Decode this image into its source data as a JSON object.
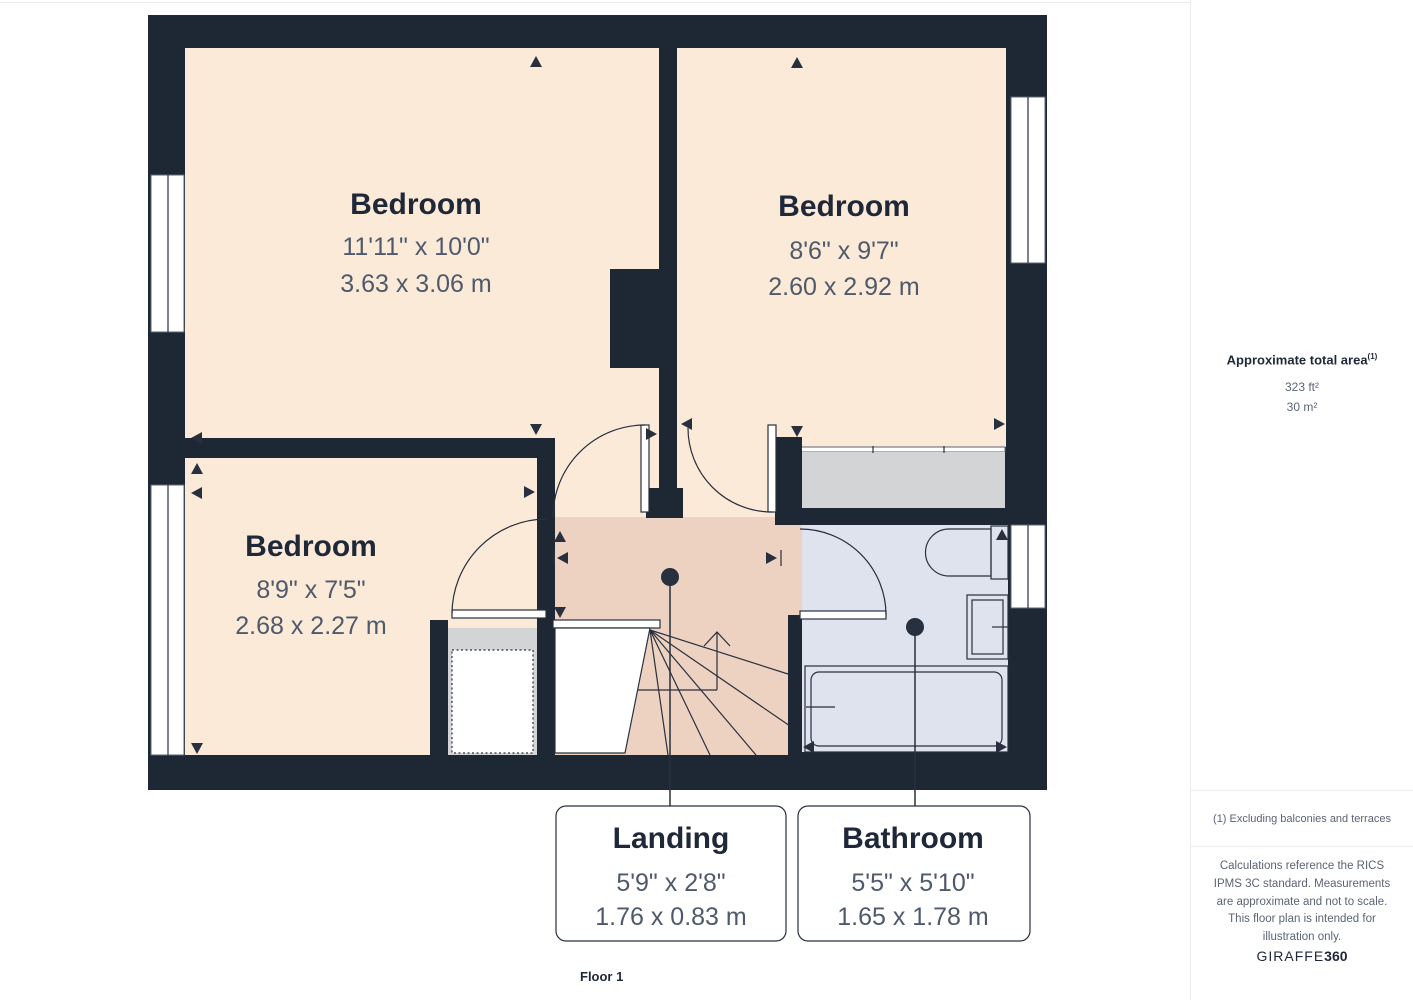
{
  "floorplan": {
    "floor_label": "Floor 1",
    "rooms": [
      {
        "name": "Bedroom",
        "dim_imperial": "11'11\" x 10'0\"",
        "dim_metric": "3.63 x 3.06 m"
      },
      {
        "name": "Bedroom",
        "dim_imperial": "8'6\" x 9'7\"",
        "dim_metric": "2.60 x 2.92 m"
      },
      {
        "name": "Bedroom",
        "dim_imperial": "8'9\" x 7'5\"",
        "dim_metric": "2.68 x 2.27 m"
      },
      {
        "name": "Landing",
        "dim_imperial": "5'9\" x 2'8\"",
        "dim_metric": "1.76 x 0.83 m"
      },
      {
        "name": "Bathroom",
        "dim_imperial": "5'5\" x 5'10\"",
        "dim_metric": "1.65 x 1.78 m"
      }
    ],
    "colors": {
      "wall": "#1e2734",
      "room": "#fcead8",
      "landing": "#edd2c1",
      "bathroom": "#dfe3ee",
      "storage": "#d3d4d6",
      "outline": "#28303f",
      "label_title": "#1f2838",
      "label_dim": "#4e5a6b"
    }
  },
  "sidebar": {
    "area_title": "Approximate total area",
    "area_footnote_marker": "(1)",
    "area_ft": "323 ft²",
    "area_m": "30 m²",
    "footnote": "(1) Excluding balconies and terraces",
    "disclaimer": "Calculations reference the RICS IPMS 3C standard. Measurements are approximate and not to scale. This floor plan is intended for illustration only.",
    "brand": {
      "name_part1": "GIRAFFE",
      "name_part2": "360"
    }
  }
}
